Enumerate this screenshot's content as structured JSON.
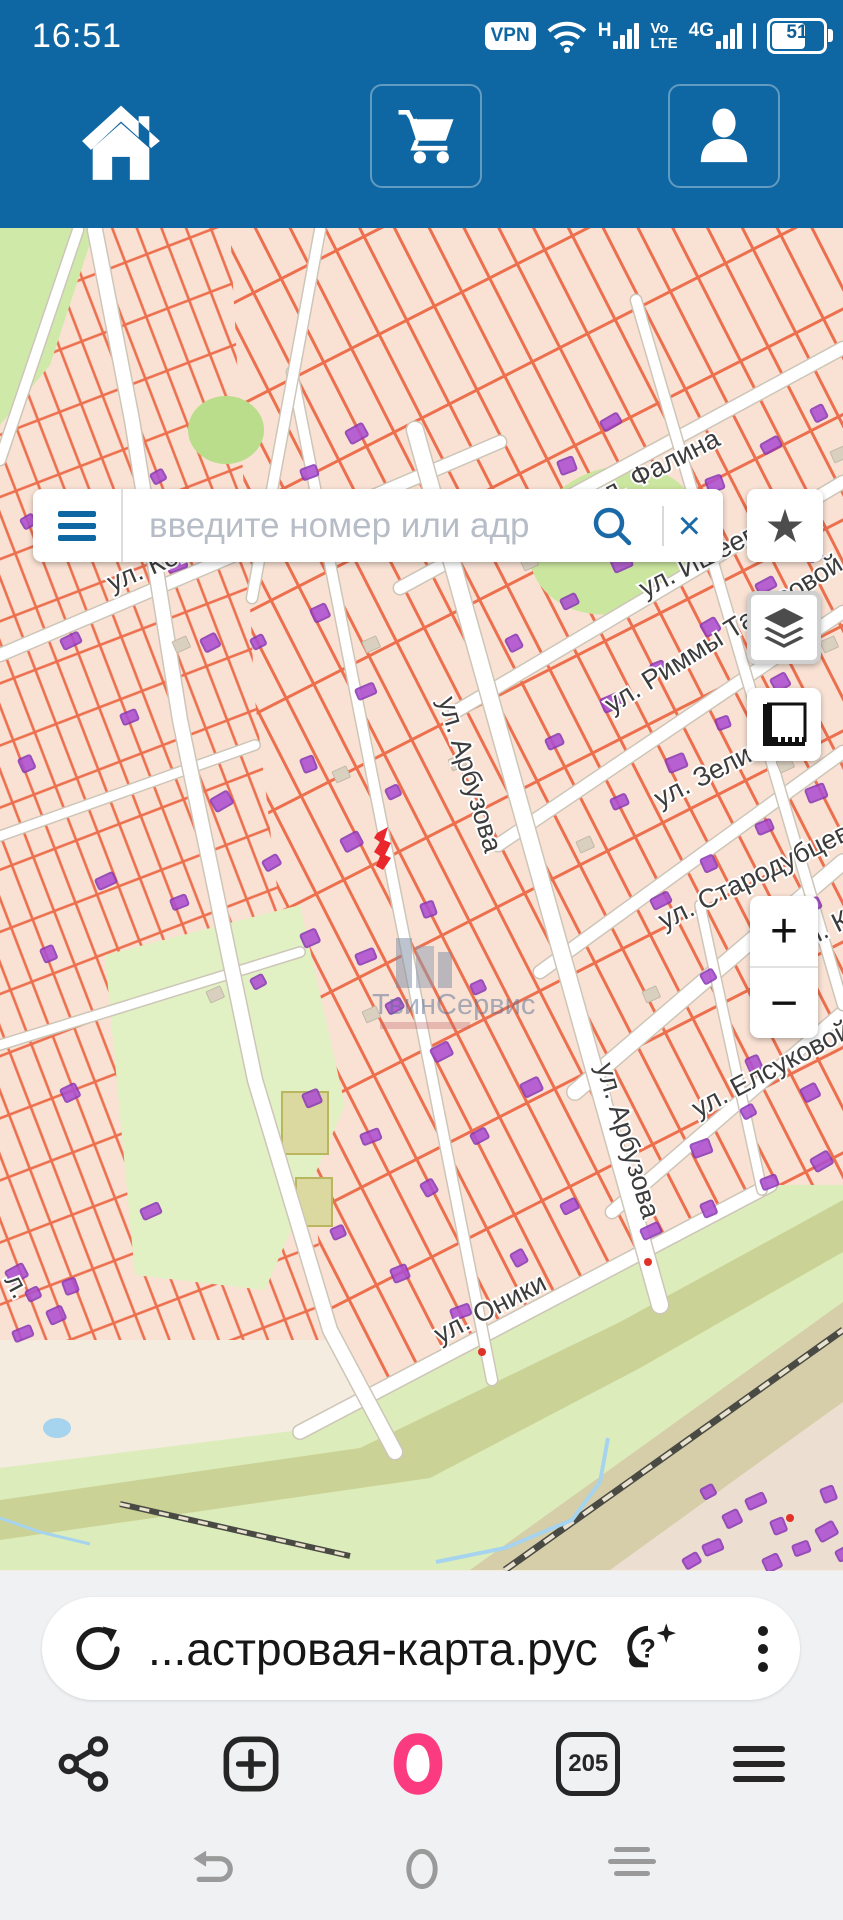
{
  "status_bar": {
    "time": "16:51",
    "vpn": "VPN",
    "net_h": "H",
    "volte_top": "Vo",
    "volte_bottom": "LTE",
    "net_4g": "4G",
    "battery_percent": "51"
  },
  "search": {
    "placeholder": "введите номер или адр",
    "clear_glyph": "×"
  },
  "controls": {
    "star_glyph": "★",
    "zoom_in": "+",
    "zoom_out": "−"
  },
  "cadastre_button": {
    "label": "Кадастровые границы"
  },
  "attribution": {
    "copyright": "© Яндекс",
    "terms": "Условия",
    "logo_first": "Я",
    "logo_rest": "ндекс"
  },
  "browser": {
    "url": "...астровая-карта.рус",
    "tab_count": "205"
  },
  "map": {
    "watermark": "ТвинСервис",
    "streets": [
      {
        "name": "ул. Когана",
        "x": 112,
        "y": 592,
        "rot": -23
      },
      {
        "name": "ул. Фалина",
        "x": 597,
        "y": 508,
        "rot": -27
      },
      {
        "name": "ул. Ишеева",
        "x": 645,
        "y": 598,
        "rot": -27
      },
      {
        "name": "ул. Риммы Тарасовой",
        "x": 612,
        "y": 714,
        "rot": -32
      },
      {
        "name": "ул. Зели",
        "x": 660,
        "y": 808,
        "rot": -27
      },
      {
        "name": "ул. Стародубцева",
        "x": 664,
        "y": 930,
        "rot": -26
      },
      {
        "name": "ул. К",
        "x": 798,
        "y": 952,
        "rot": -26
      },
      {
        "name": "ул. Елсуковой",
        "x": 698,
        "y": 1118,
        "rot": -28
      },
      {
        "name": "ул. Оники",
        "x": 440,
        "y": 1344,
        "rot": -27
      },
      {
        "name": "ул. Арбузова",
        "x": 438,
        "y": 700,
        "rot": 73
      },
      {
        "name": "ул. Арбузова",
        "x": 596,
        "y": 1066,
        "rot": 73
      },
      {
        "name": "л.",
        "x": 4,
        "y": 1280,
        "rot": 62
      }
    ],
    "buildings": [
      [
        20,
        520
      ],
      [
        75,
        500
      ],
      [
        60,
        640
      ],
      [
        18,
        760
      ],
      [
        120,
        715
      ],
      [
        165,
        560
      ],
      [
        150,
        475
      ],
      [
        200,
        640
      ],
      [
        95,
        880
      ],
      [
        40,
        950
      ],
      [
        170,
        900
      ],
      [
        210,
        800
      ],
      [
        250,
        980
      ],
      [
        60,
        1090
      ],
      [
        140,
        1210
      ],
      [
        255,
        525
      ],
      [
        300,
        470
      ],
      [
        345,
        432
      ],
      [
        250,
        640
      ],
      [
        310,
        610
      ],
      [
        355,
        690
      ],
      [
        300,
        760
      ],
      [
        262,
        862
      ],
      [
        340,
        840
      ],
      [
        385,
        790
      ],
      [
        300,
        935
      ],
      [
        355,
        955
      ],
      [
        420,
        905
      ],
      [
        385,
        1005
      ],
      [
        430,
        1050
      ],
      [
        470,
        985
      ],
      [
        302,
        1095
      ],
      [
        360,
        1135
      ],
      [
        420,
        1185
      ],
      [
        470,
        1135
      ],
      [
        520,
        1085
      ],
      [
        330,
        1230
      ],
      [
        390,
        1270
      ],
      [
        450,
        1310
      ],
      [
        510,
        1255
      ],
      [
        560,
        1205
      ],
      [
        460,
        545
      ],
      [
        510,
        500
      ],
      [
        557,
        462
      ],
      [
        600,
        422
      ],
      [
        505,
        640
      ],
      [
        560,
        600
      ],
      [
        610,
        560
      ],
      [
        660,
        520
      ],
      [
        705,
        480
      ],
      [
        760,
        445
      ],
      [
        810,
        410
      ],
      [
        545,
        740
      ],
      [
        600,
        700
      ],
      [
        650,
        665
      ],
      [
        700,
        625
      ],
      [
        755,
        585
      ],
      [
        805,
        550
      ],
      [
        610,
        800
      ],
      [
        665,
        760
      ],
      [
        715,
        720
      ],
      [
        770,
        680
      ],
      [
        650,
        900
      ],
      [
        700,
        860
      ],
      [
        755,
        825
      ],
      [
        805,
        790
      ],
      [
        700,
        975
      ],
      [
        752,
        940
      ],
      [
        800,
        905
      ],
      [
        745,
        1060
      ],
      [
        795,
        1025
      ],
      [
        690,
        1145
      ],
      [
        740,
        1110
      ],
      [
        800,
        1090
      ],
      [
        640,
        1230
      ],
      [
        700,
        1205
      ],
      [
        760,
        1180
      ],
      [
        810,
        1160
      ],
      [
        700,
        1490
      ],
      [
        722,
        1516
      ],
      [
        745,
        1500
      ],
      [
        770,
        1522
      ],
      [
        792,
        1546
      ],
      [
        815,
        1530
      ],
      [
        835,
        1552
      ],
      [
        762,
        1560
      ],
      [
        702,
        1546
      ],
      [
        820,
        1490
      ],
      [
        682,
        1560
      ],
      [
        5,
        1272
      ],
      [
        25,
        1292
      ],
      [
        46,
        1312
      ],
      [
        12,
        1332
      ],
      [
        62,
        1282
      ]
    ],
    "gray_buildings": [
      [
        332,
        772
      ],
      [
        362,
        642
      ],
      [
        576,
        842
      ],
      [
        642,
        992
      ],
      [
        820,
        642
      ],
      [
        206,
        992
      ],
      [
        362,
        1012
      ],
      [
        172,
        642
      ],
      [
        830,
        452
      ],
      [
        776,
        762
      ],
      [
        520,
        560
      ],
      [
        448,
        760
      ]
    ],
    "red_dots": [
      [
        648,
        1262
      ],
      [
        482,
        1352
      ],
      [
        790,
        1518
      ]
    ]
  }
}
